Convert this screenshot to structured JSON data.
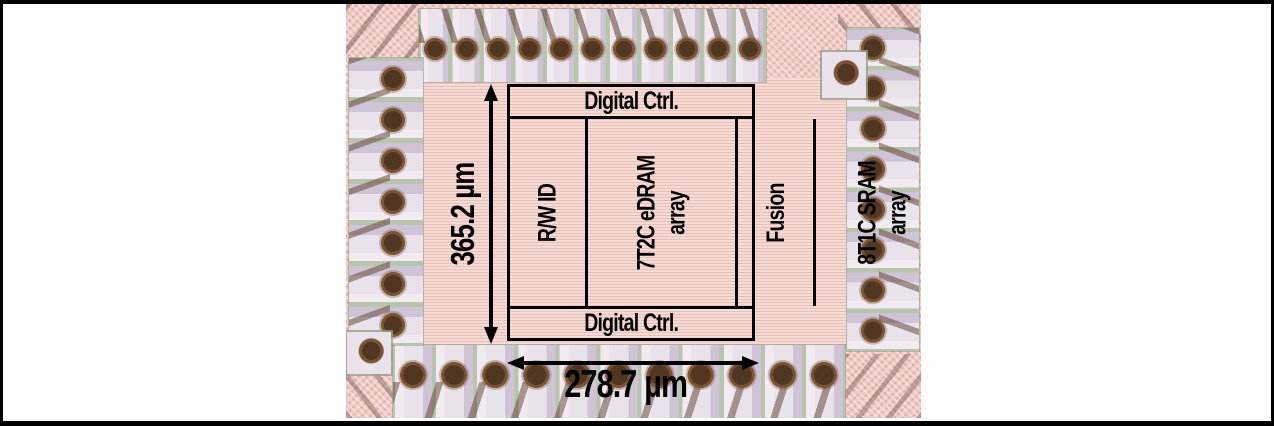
{
  "die_photo": {
    "floorplan": {
      "top_block": "Digital Ctrl.",
      "bottom_block": "Digital Ctrl.",
      "columns": [
        {
          "line1": "R/W ID"
        },
        {
          "line1": "7T2C eDRAM",
          "line2": "array"
        },
        {
          "line1": "Fusion"
        },
        {
          "line1": "8T1C SRAM",
          "line2": "array"
        },
        {
          "line1": "R/W ID"
        }
      ]
    },
    "dimensions": {
      "height": "365.2 µm",
      "width": "278.7 µm"
    },
    "colors": {
      "annotation": "#000000",
      "die_surface": "#f6dbd5",
      "chip_margin": "#efc9c2",
      "pad_metal": "#e9e2eb",
      "pad_gap": "#b9c4ae",
      "bond_ball": "#513722",
      "bond_wire": "#5c3f2e",
      "figure_background": "#ffffff"
    }
  }
}
